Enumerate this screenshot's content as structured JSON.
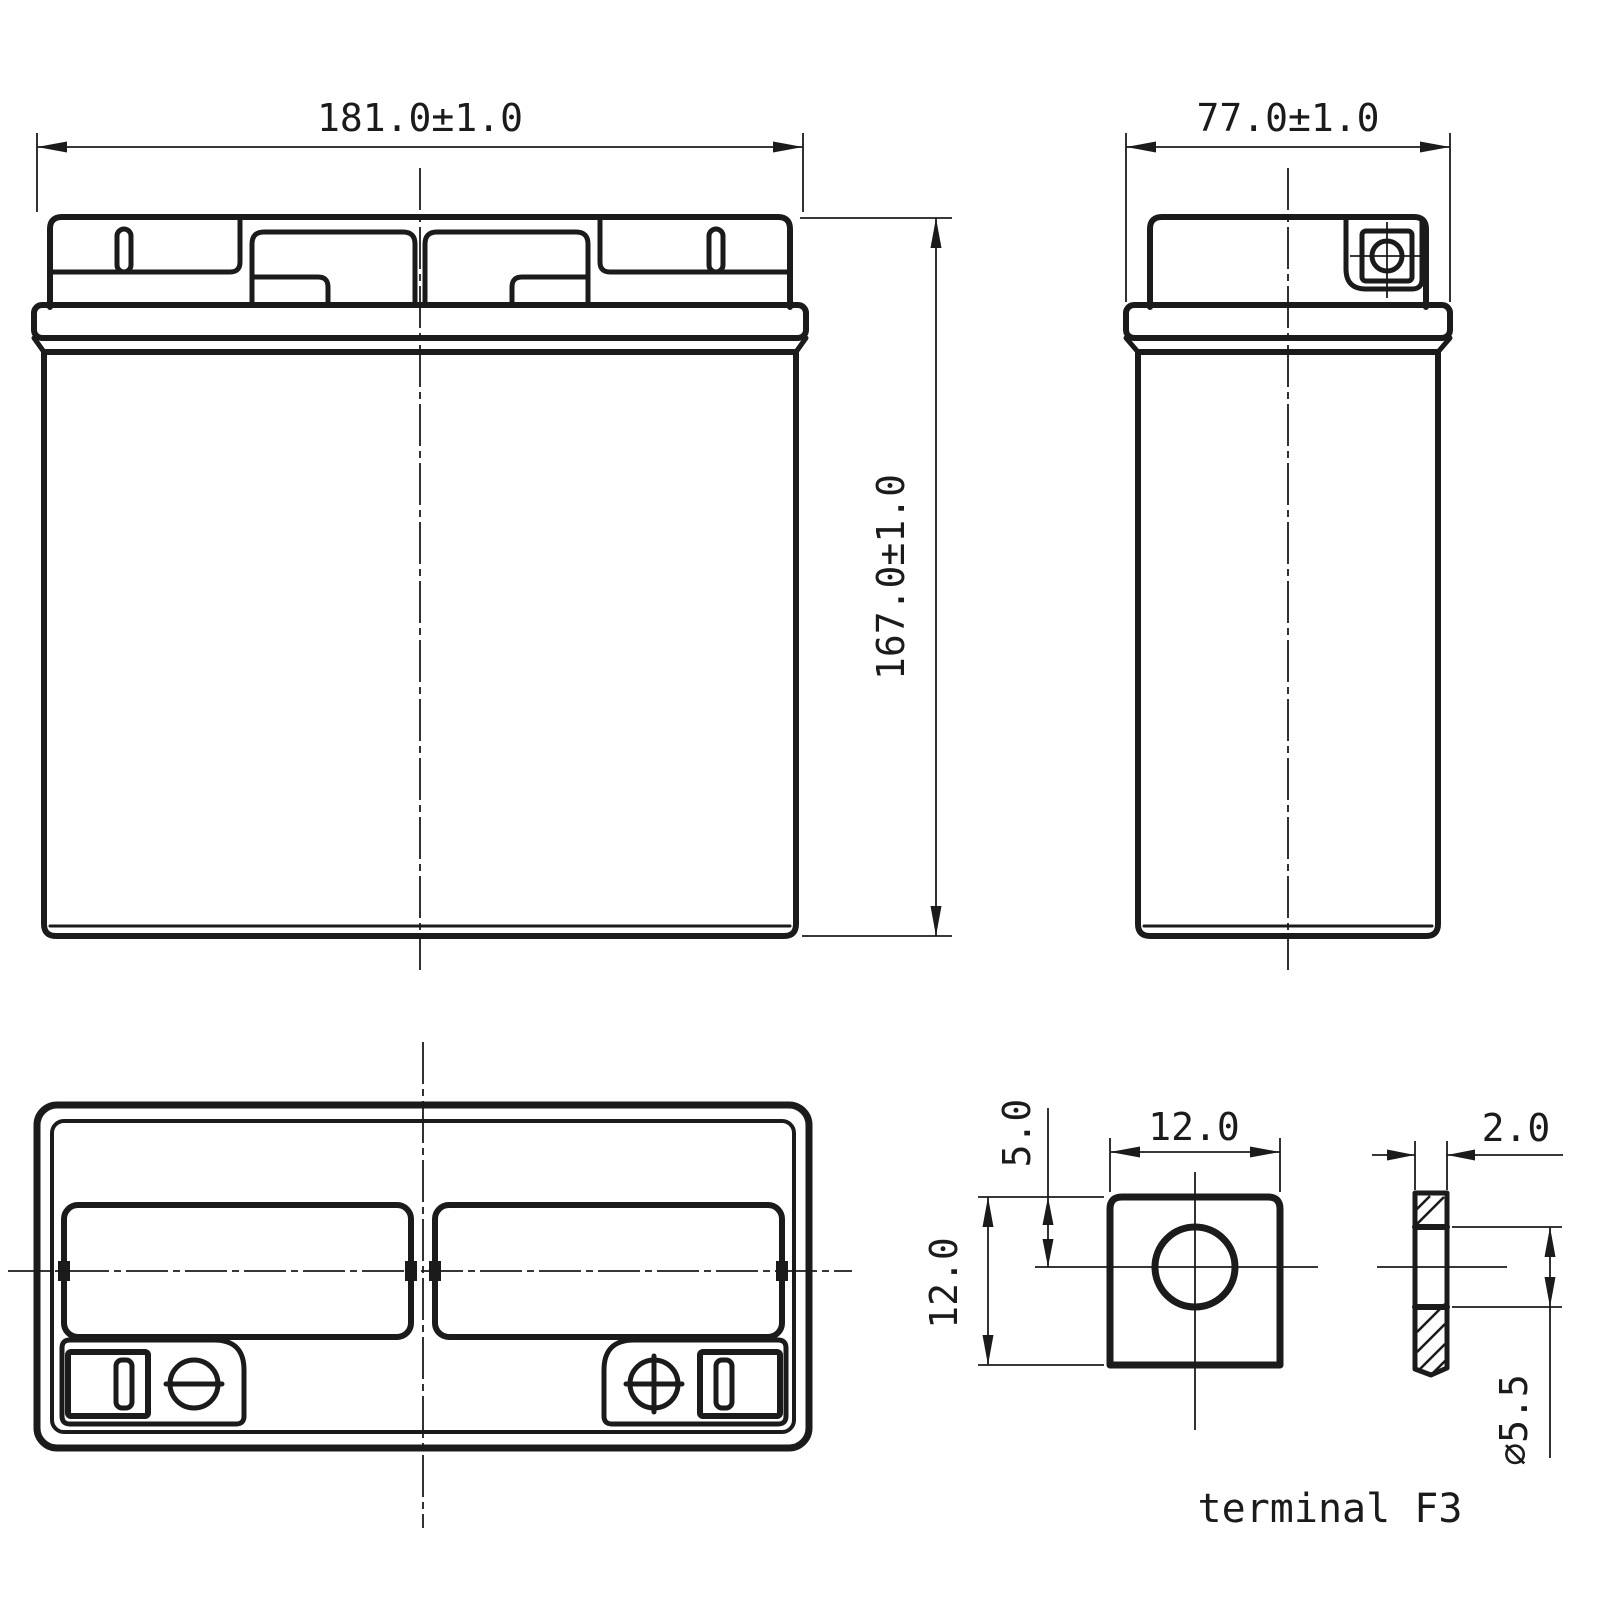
{
  "drawing": {
    "background": "#ffffff",
    "line_color": "#1b1b1b",
    "front_view": {
      "width_dim": "181.0±1.0",
      "height_dim": "167.0±1.0"
    },
    "side_view": {
      "width_dim": "77.0±1.0"
    },
    "top_view": {
      "negative_terminal_symbol": "minus-in-circle",
      "positive_terminal_symbol": "plus-in-circle"
    },
    "terminal_detail": {
      "pad_width_dim": "12.0",
      "hole_offset_dim": "5.0",
      "pad_height_dim": "12.0",
      "thickness_dim": "2.0",
      "hole_diameter_dim": "⌀5.5",
      "caption": "terminal F3"
    }
  }
}
